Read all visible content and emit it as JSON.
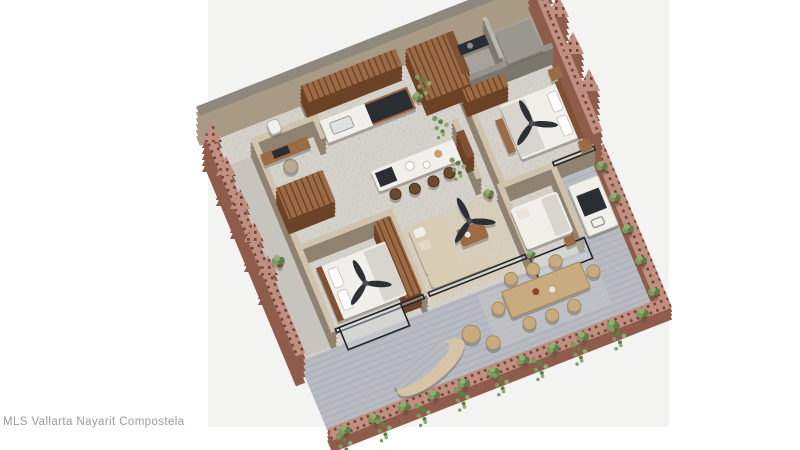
{
  "caption": {
    "text": "MLS Vallarta Nayarit Compostela"
  },
  "render": {
    "description": "Isometric 3D floor plan render: apartment with kitchen, bathroom, two bedrooms, living-dining area and a large terrace with outdoor dining, lounge and BBQ, enclosed by perforated red-brick walls with hanging plants",
    "canvas": {
      "x": 208,
      "y": 0,
      "width": 461,
      "height": 427
    }
  },
  "colors": {
    "bg": "#ffffff",
    "canvas": "#f3f4f2",
    "caption": "#9a9a9a",
    "brick": "#c18f7f",
    "brickSide": "#8f5c4c",
    "brickDot": "#6f453a",
    "wall": "#c6b8a1",
    "wallTop": "#cfc3ad",
    "wallSide": "#8f8271",
    "wallGreyTop": "#8e897c",
    "wallGreySide": "#a89a84",
    "greyWall": "#97938a",
    "greyWallSide": "#7b776d",
    "wood": "#9c6a45",
    "woodSide": "#6b4226",
    "woodDark": "#7e5233",
    "floorIn": "#d4d1ca",
    "floorSpeck": "#c1bdb4",
    "bathFloor": "#a7a39b",
    "patio": "#c7c4bd",
    "terr": "#b7bac1",
    "terrLine": "#a9adb4",
    "white": "#f0efe9",
    "blanket": "#d8d5cf",
    "dark": "#2a2d32",
    "sofa": "#d8ccb4",
    "rug": "#d8caae",
    "chairTan": "#c8ab7f",
    "chairEdge": "#a68a5e",
    "green": "#7c9a60",
    "green2": "#5f7f4a",
    "green3": "#8fae70",
    "glass": "#d4e0e2",
    "frame": "#22262a"
  }
}
